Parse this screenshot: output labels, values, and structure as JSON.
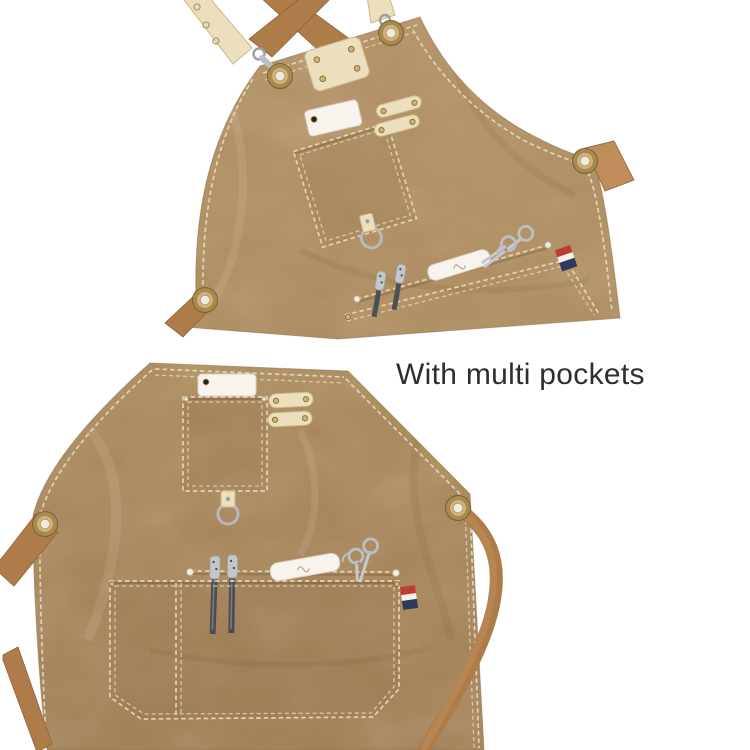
{
  "caption": {
    "text": "With multi pockets"
  },
  "palette": {
    "bg": "#ffffff",
    "canvas": "#ab8a5e",
    "canvas_hi": "#b39166",
    "canvas_lo": "#a17f57",
    "stitch": "#e4d8b6",
    "strap": "#ad7c49",
    "strap_lo": "#8f6239",
    "strap_hi": "#c08d5a",
    "cream": "#ecdfbd",
    "cream_lo": "#cdb98c",
    "metal": "#bcbfc1",
    "metal_lo": "#8d9297",
    "brass": "#a8894e",
    "brass_hi": "#cfb37a",
    "flag_red": "#c03a36",
    "flag_navy": "#2c3a5e",
    "white_warm": "#f8f3ec",
    "ink": "#2e2e2e"
  }
}
